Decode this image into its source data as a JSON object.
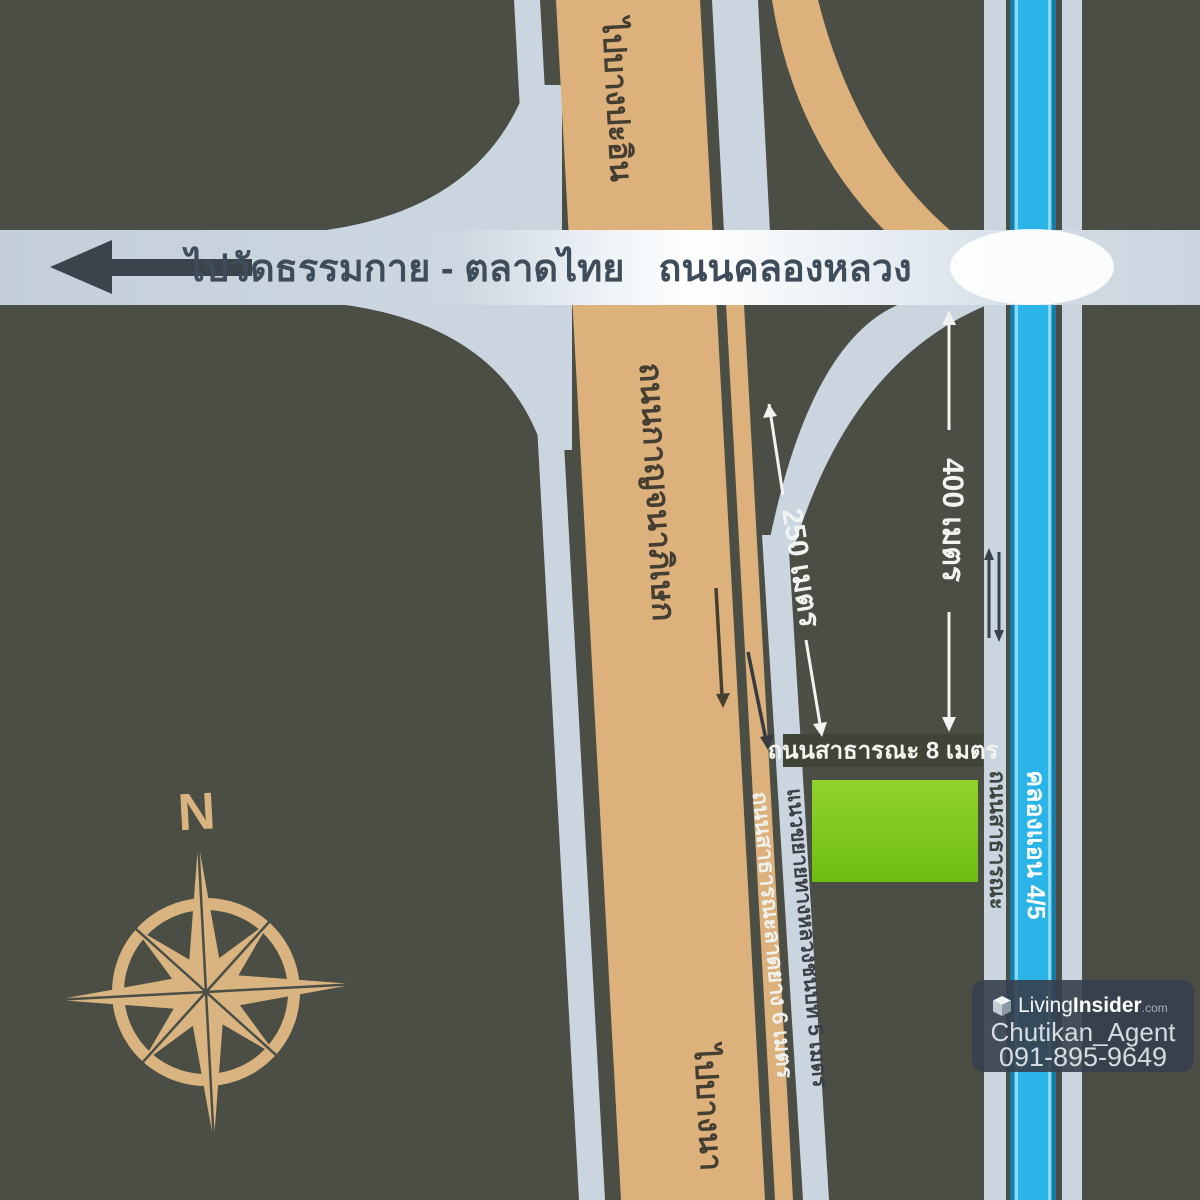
{
  "colors": {
    "background": "#4a4e45",
    "road_light": "#cbd5df",
    "road_tan": "#dcb17c",
    "canal_blue": "#2ab4e7",
    "plot_green": "#7cc81e",
    "compass_tan": "#d9b480"
  },
  "highway": {
    "name": "ถนนคลองหลวง",
    "direction_west": "ไปวัดธรรมกาย - ตลาดไทย"
  },
  "main_road": {
    "name": "ถนนกาญจนาภิเษก",
    "to_north": "ไปบางปะอิน",
    "to_south": "ไปบางนา"
  },
  "side_roads": {
    "public_8m": "ถนนสาธารณะ 8 เมตร",
    "asphalt_6m": "ถนนสาธารณะลาดยาง 6 เมตร",
    "expansion_5m": "แนวขยายทางหลวงชนบท 5 เมตร",
    "public_vertical": "ถนนสาธารณะ"
  },
  "canal": {
    "name": "คลองแอน 4/5"
  },
  "distances": {
    "west": "250 เมตร",
    "east": "400 เมตร"
  },
  "compass": {
    "north": "N"
  },
  "watermark": {
    "brand_a": "Living",
    "brand_b": "Insider",
    "brand_suffix": ".com",
    "agent": "Chutikan_Agent",
    "phone": "091-895-9649"
  }
}
